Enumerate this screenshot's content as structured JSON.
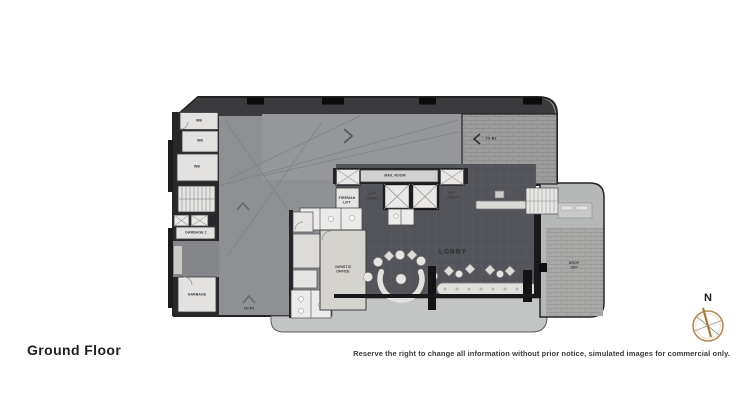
{
  "page": {
    "title": "Ground Floor",
    "disclaimer": "Reserve the right to change all information without prior notice, simulated images for commercial only.",
    "compass": {
      "label": "N"
    }
  },
  "plan": {
    "labels": {
      "wb1": "WB",
      "wb2": "WB",
      "wb3": "WB",
      "garbage1": "GARBAGE 1",
      "garbage2": "GARBAGE",
      "to_p2": "TO P2",
      "to_b1": "TO B1",
      "fireman_lift": "FIREMAN\nLIFT",
      "mail_room": "MAIL ROOM",
      "lift_lobby_left": "LIFT\nLOBBY",
      "lift_lobby_right": "LIFT\nLOBBY",
      "juristic_office": "JURISTIC\nOFFICE",
      "lobby": "LOBBY",
      "drop_off": "DROP\nOFF"
    },
    "icons": {
      "compass": "compass-rose",
      "up_arrow": "chevron-up",
      "right_arrow": "chevron-right",
      "left_arrow": "chevron-left"
    },
    "colors": {
      "wall": "#232325",
      "body": "#8e9093",
      "top_band": "#3a3a3c",
      "lobby_floor": "#53545a",
      "room_light": "#e4e3e1",
      "office": "#d5d3cd",
      "walkway": "#c3c5c4",
      "brick": "#9d9d9e",
      "compass_ring": "#b58a55",
      "compass_needle": "#a87a40"
    }
  }
}
